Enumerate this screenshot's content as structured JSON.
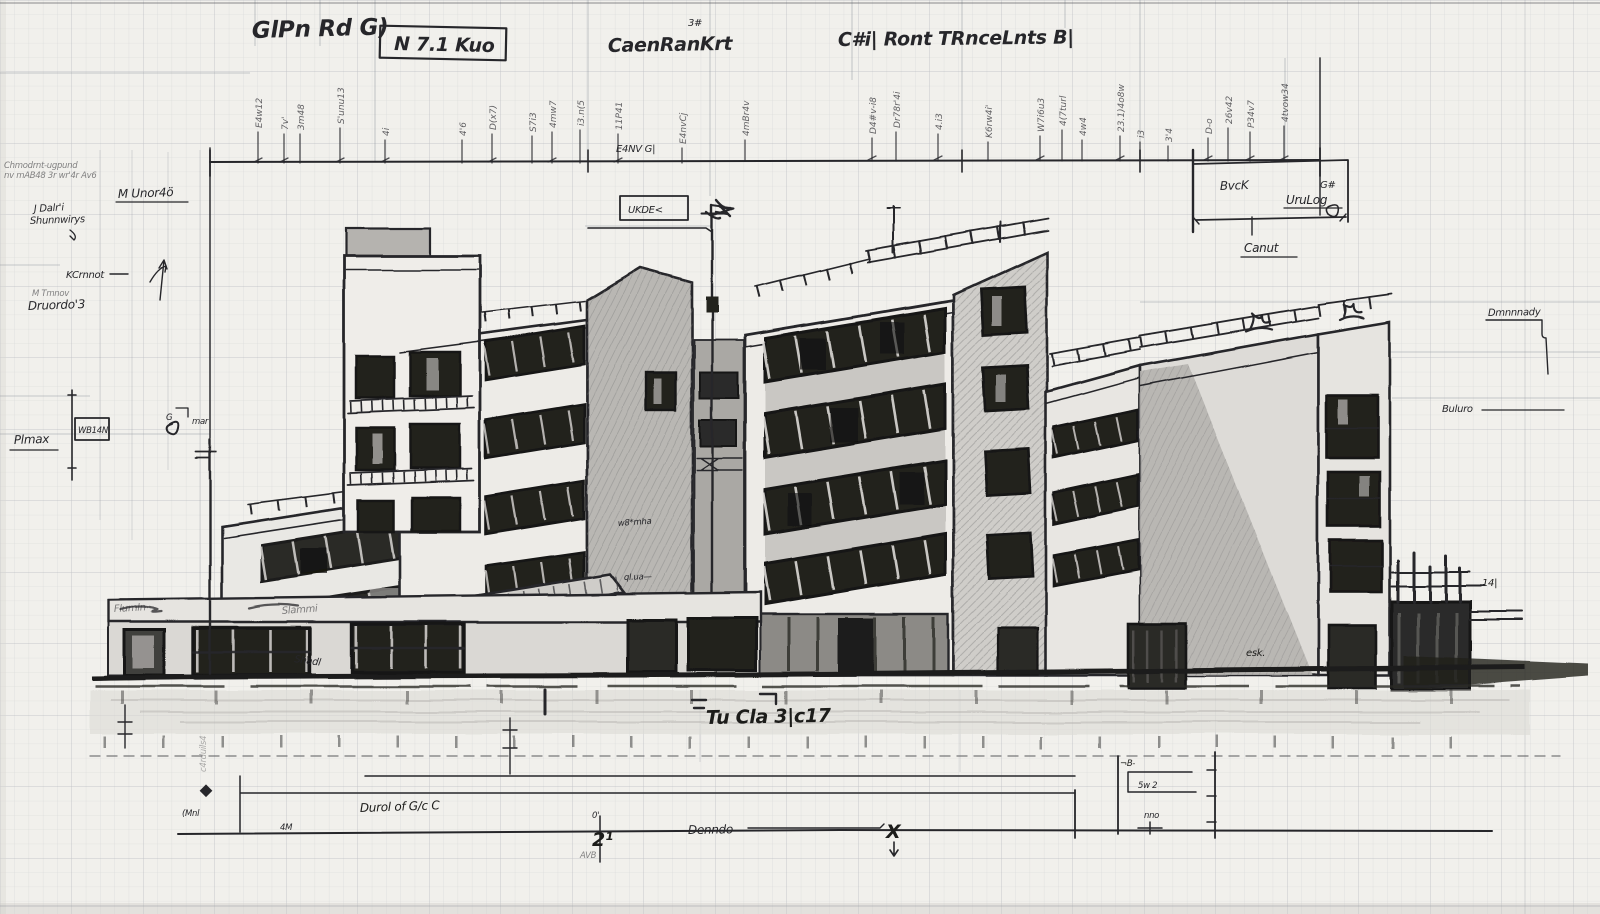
{
  "header": {
    "left_title": "GlPn Rd  G)",
    "scale_box": "N  7.1 Kuo",
    "center_title": "CaenRanKrt",
    "center_sup": "3#",
    "right_title": "C#i| Ront  TRnceLnts  B|"
  },
  "dim_ticks": {
    "labels": [
      "E4w12",
      "7v'",
      "3m48",
      "S'unu13",
      "4i",
      "4'6",
      "D(x7)",
      "S7i3",
      "4mw7",
      "i3.n(5",
      "11P41",
      "E4nvCj",
      "4mBr4v",
      "D4#v-i8",
      "Dr78r'4i",
      "4.i3",
      "K6rw4i'",
      "W7i6u3",
      "4(7turl",
      "4w4",
      "23.1)4o8w",
      "i3",
      "3'4",
      "D-o",
      "26v42",
      "P34v7",
      "4tvow34"
    ]
  },
  "left_margin": {
    "note_line1": "Chmodrnt-ugpund",
    "note_line2": "nv mAB48 3r wr'4r Av6",
    "unit_label": "M  Unor4ö",
    "sig_line1": "J Dalr'i",
    "sig_line2": "Shunnwirys",
    "kc_label": "KCrnnot",
    "sig2_line1": "M Tmnov",
    "sig2_line2": "Druordo'3",
    "plmax_label": "Plmax",
    "box_label": "WB14N",
    "box_mark": "G",
    "box_side": "mar",
    "vertical_scrawl": "c4rduils4"
  },
  "right_margin": {
    "bvck_label": "BvcK",
    "urulog_label": "UruLog",
    "corner_mark": "G#",
    "canut_label": "Canut",
    "dmn_label": "Dmnnnady",
    "buluro_label": "Buluro",
    "kiosk_mark": "14|"
  },
  "bottom": {
    "street_label": "Tu Cla 3|c17",
    "duct_label": "Durol of G/c C",
    "dim_left": "4M",
    "zero_mark": "0'",
    "dim_mid": "2¹",
    "avb_mark": "AVB",
    "denndo_label": "Denndo",
    "x_mark": "X",
    "mnl_mark": "(Mnl",
    "bracket_top_mark": "¬B-",
    "bracket_mark1": "5w 2",
    "bracket_mark2": "nno"
  },
  "building_scrawls": {
    "e4nvg": "E4NV G|",
    "uude_box": "UKDE<",
    "slammi": "Slammi",
    "flumln": "Flumln",
    "shadl": "Shadl",
    "wurha": "w8*mha",
    "qlua": "ql.ua—",
    "esk": "esk."
  },
  "colors": {
    "paper": "#f1f0ec",
    "pencil": "#26262a",
    "shade_wall": "#b9b7b3",
    "spandrel": "#c9c7c3",
    "window_dark": "#23221f",
    "ground_wash": "#dcdad5"
  }
}
